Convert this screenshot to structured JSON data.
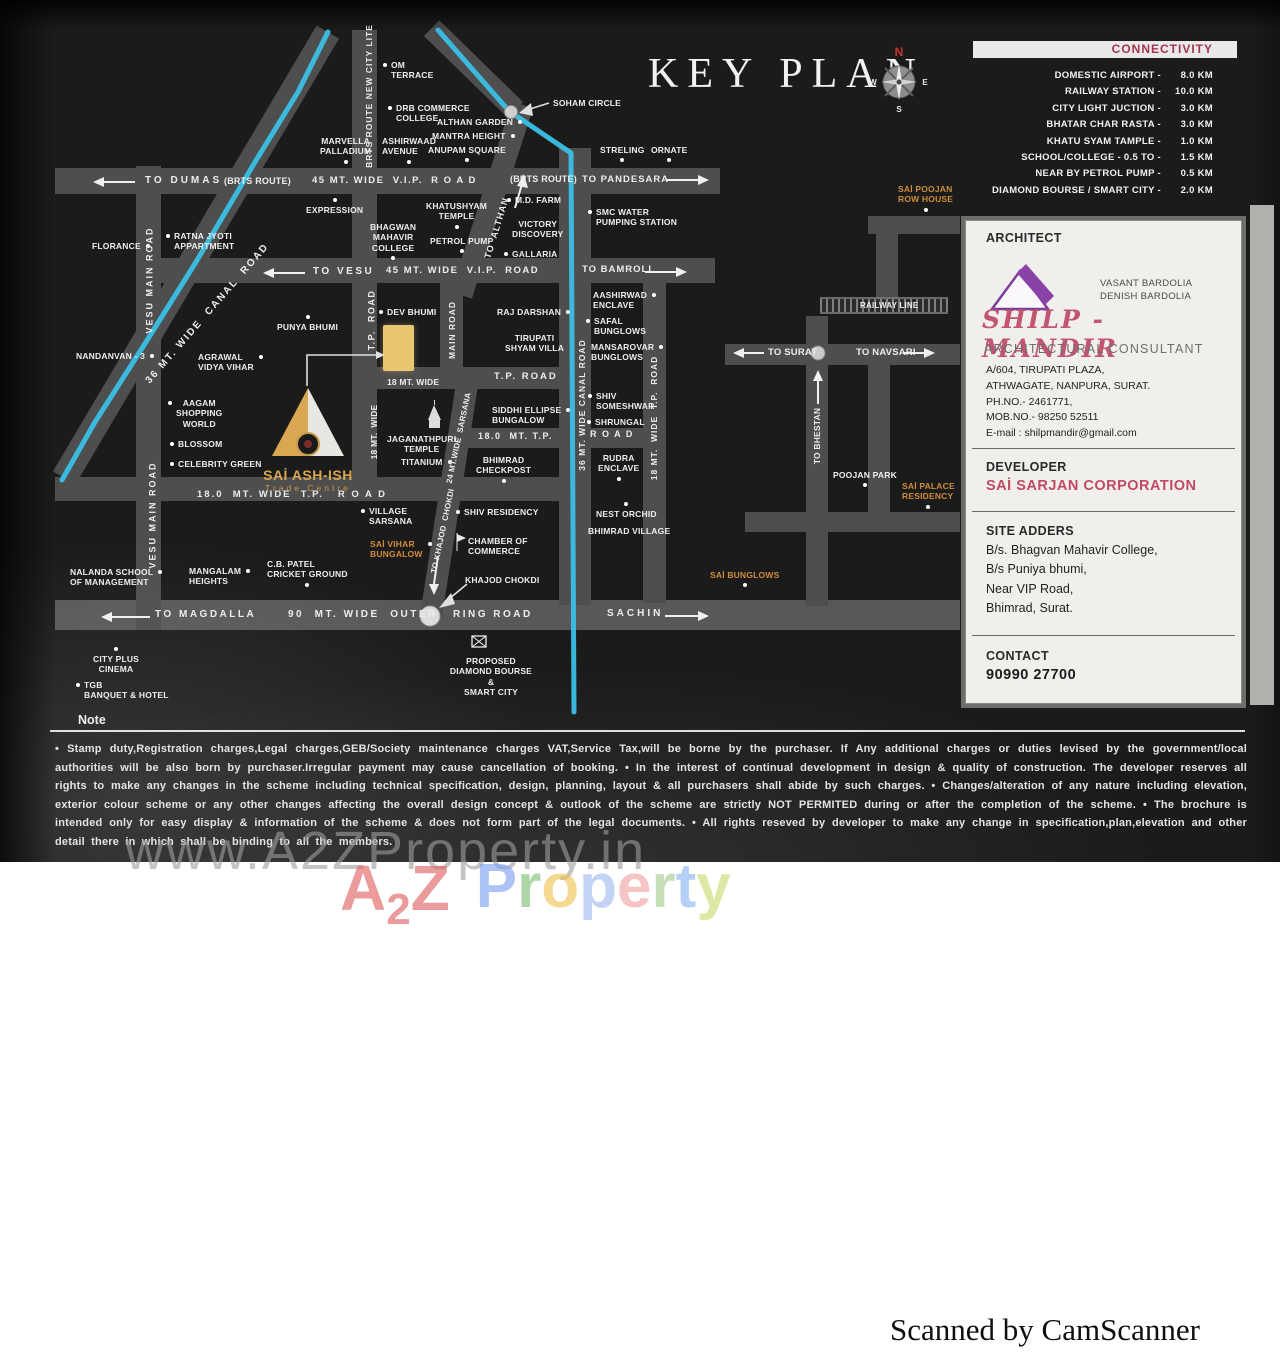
{
  "page": {
    "title": "KEY PLAN",
    "note_title": "Note",
    "note_text": "• Stamp duty,Registration charges,Legal charges,GEB/Society maintenance charges VAT,Service Tax,will be borne by the purchaser. If Any additional charges or duties levised by the government/local authorities will be also born by purchaser.Irregular payment may cause cancellation of booking. • In the interest of continual development in design & quality of construction. The developer reserves all rights to make any changes in the scheme including technical specification, design, planning, layout & all purchasers shall abide by such charges. • Changes/alteration of any nature including elevation, exterior colour scheme or any other changes affecting the overall design concept & outlook of the scheme are strictly NOT PERMITED during or after the completion of the scheme. • The brochure is intended only for easy display & information of the scheme & does not form part of the legal documents. • All rights reseved by developer to make any change in specification,plan,elevation and other detail there in which shall be binding to all the members.",
    "scanner_credit": "Scanned by CamScanner"
  },
  "compass": {
    "north": "N",
    "east": "E",
    "south": "S",
    "west": "W"
  },
  "connectivity": {
    "header": "CONNECTIVITY",
    "items": [
      {
        "label": "DOMESTIC AIRPORT -",
        "km": "8.0 KM"
      },
      {
        "label": "RAILWAY STATION  -",
        "km": "10.0 KM"
      },
      {
        "label": "CITY LIGHT JUCTION -",
        "km": "3.0 KM"
      },
      {
        "label": "BHATAR CHAR RASTA -",
        "km": "3.0 KM"
      },
      {
        "label": "KHATU SYAM TAMPLE -",
        "km": "1.0 KM"
      },
      {
        "label": "SCHOOL/COLLEGE - 0.5 TO -",
        "km": "1.5 KM"
      },
      {
        "label": "NEAR BY PETROL PUMP -",
        "km": "0.5 KM"
      },
      {
        "label": "DIAMOND BOURSE / SMART CITY -",
        "km": "2.0 KM"
      }
    ]
  },
  "info_card": {
    "architect": {
      "heading": "ARCHITECT",
      "names": [
        "VASANT BARDOLIA",
        "DENISH BARDOLIA"
      ],
      "brand": "SHILP - MANDIR",
      "subtitle": "ARCHITECTURAL CONSULTANT",
      "address_lines": [
        "A/604, TIRUPATI PLAZA,",
        "ATHWAGATE, NANPURA, SURAT.",
        "PH.NO.- 2461771,",
        "MOB.NO.- 98250 52511",
        "E-mail : shilpmandir@gmail.com"
      ]
    },
    "developer": {
      "heading": "DEVELOPER",
      "name": "SAİ SARJAN CORPORATION"
    },
    "site": {
      "heading": "SITE ADDERS",
      "lines": [
        "B/s. Bhagvan Mahavir College,",
        "B/s Puniya bhumi,",
        "Near VIP Road,",
        "Bhimrad, Surat."
      ]
    },
    "contact": {
      "heading": "CONTACT",
      "phone": "90990 27700"
    }
  },
  "map": {
    "site_logo": {
      "name": "SAİ ASH-ISH",
      "tagline": "Trade Centre"
    },
    "accent_colors": {
      "orange_label": "#cf8c3a",
      "canal": "#3ac0e6",
      "gold_plot": "#e9c771"
    },
    "labels": [
      {
        "t": "OM\nTERRACE",
        "x": 391,
        "y": 60,
        "d": "l"
      },
      {
        "t": "DRB COMMERCE\nCOLLEGE",
        "x": 396,
        "y": 103,
        "d": "l"
      },
      {
        "t": "ALTHAN GARDEN",
        "x": 437,
        "y": 117,
        "d": "r"
      },
      {
        "t": "MANTRA HEIGHT",
        "x": 432,
        "y": 131,
        "d": "r"
      },
      {
        "t": "ANUPAM SQUARE",
        "x": 428,
        "y": 145,
        "d": "b"
      },
      {
        "t": "ASHIRWAAD\nAVENUE",
        "x": 382,
        "y": 136,
        "d": "b"
      },
      {
        "t": "MARVELLA\nPALLADIUM",
        "x": 320,
        "y": 136,
        "a": 1,
        "d": "b"
      },
      {
        "t": "SOHAM CIRCLE",
        "x": 553,
        "y": 98
      },
      {
        "t": "STRELING",
        "x": 600,
        "y": 145,
        "d": "b"
      },
      {
        "t": "ORNATE",
        "x": 651,
        "y": 145,
        "d": "b"
      },
      {
        "t": "EXPRESSION",
        "x": 306,
        "y": 205,
        "d": "t"
      },
      {
        "t": "KHATUSHYAM\nTEMPLE",
        "x": 426,
        "y": 201,
        "a": 1,
        "d": "b"
      },
      {
        "t": "M.D. FARM",
        "x": 515,
        "y": 195,
        "d": "l"
      },
      {
        "t": "SMC WATER\nPUMPING STATION",
        "x": 596,
        "y": 207,
        "d": "l"
      },
      {
        "t": "VICTORY\nDISCOVERY",
        "x": 512,
        "y": 219,
        "a": 1
      },
      {
        "t": "BHAGWAN\nMAHAVIR\nCOLLEGE",
        "x": 370,
        "y": 222,
        "a": 1,
        "d": "b"
      },
      {
        "t": "PETROL PUMP",
        "x": 430,
        "y": 236,
        "d": "b"
      },
      {
        "t": "GALLARIA",
        "x": 512,
        "y": 249,
        "d": "l"
      },
      {
        "t": "FLORANCE",
        "x": 92,
        "y": 241,
        "d": "r"
      },
      {
        "t": "RATNA JYOTI\nAPPARTMENT",
        "x": 174,
        "y": 231,
        "d": "l"
      },
      {
        "t": "NANDANVAN - 3",
        "x": 76,
        "y": 351,
        "d": "r"
      },
      {
        "t": "AGRAWAL\nVIDYA VIHAR",
        "x": 198,
        "y": 352,
        "d": "r"
      },
      {
        "t": "PUNYA BHUMI",
        "x": 277,
        "y": 322,
        "d": "t"
      },
      {
        "t": "DEV BHUMI",
        "x": 387,
        "y": 307,
        "d": "l"
      },
      {
        "t": "RAJ DARSHAN",
        "x": 497,
        "y": 307,
        "d": "r"
      },
      {
        "t": "TIRUPATI\nSHYAM VILLA",
        "x": 505,
        "y": 333,
        "a": 1
      },
      {
        "t": "AASHIRWAD\nENCLAVE",
        "x": 593,
        "y": 290,
        "d": "r"
      },
      {
        "t": "SAFAL\nBUNGLOWS",
        "x": 594,
        "y": 316,
        "d": "l"
      },
      {
        "t": "MANSAROVAR\nBUNGLOWS",
        "x": 591,
        "y": 342,
        "d": "r"
      },
      {
        "t": "SHIV\nSOMESHWAR",
        "x": 596,
        "y": 391,
        "d": "l"
      },
      {
        "t": "SHRUNGAL",
        "x": 595,
        "y": 417,
        "d": "l"
      },
      {
        "t": "RUDRA\nENCLAVE",
        "x": 598,
        "y": 453,
        "a": 1,
        "d": "b"
      },
      {
        "t": "NEST ORCHID",
        "x": 596,
        "y": 509,
        "d": "t"
      },
      {
        "t": "BHIMRAD VILLAGE",
        "x": 588,
        "y": 526
      },
      {
        "t": "AAGAM\nSHOPPING\nWORLD",
        "x": 176,
        "y": 398,
        "a": 1,
        "d": "l"
      },
      {
        "t": "BLOSSOM",
        "x": 178,
        "y": 439,
        "d": "l"
      },
      {
        "t": "CELEBRITY GREEN",
        "x": 178,
        "y": 459,
        "d": "l"
      },
      {
        "t": "JAGANATHPURI\nTEMPLE",
        "x": 387,
        "y": 434,
        "a": 1
      },
      {
        "t": "TITANIUM",
        "x": 401,
        "y": 457,
        "d": "r"
      },
      {
        "t": "SIDDHI ELLIPSE\nBUNGALOW",
        "x": 492,
        "y": 405,
        "d": "r"
      },
      {
        "t": "BHIMRAD\nCHECKPOST",
        "x": 476,
        "y": 455,
        "a": 1,
        "d": "b"
      },
      {
        "t": "VILLAGE\nSARSANA",
        "x": 369,
        "y": 506,
        "d": "l"
      },
      {
        "t": "SAİ VIHAR\nBUNGALOW",
        "x": 370,
        "y": 539,
        "c": "o",
        "d": "r"
      },
      {
        "t": "SHIV RESIDENCY",
        "x": 464,
        "y": 507,
        "d": "l"
      },
      {
        "t": "CHAMBER OF\nCOMMERCE",
        "x": 468,
        "y": 536
      },
      {
        "t": "KHAJOD CHOKDI",
        "x": 465,
        "y": 575
      },
      {
        "t": "C.B. PATEL\nCRICKET GROUND",
        "x": 267,
        "y": 559,
        "d": "b"
      },
      {
        "t": "MANGALAM\nHEIGHTS",
        "x": 189,
        "y": 566,
        "d": "r"
      },
      {
        "t": "NALANDA SCHOOL\nOF MANAGEMENT",
        "x": 70,
        "y": 567,
        "d": "r"
      },
      {
        "t": "CITY PLUS\nCINEMA",
        "x": 93,
        "y": 654,
        "a": 1,
        "d": "t"
      },
      {
        "t": "TGB\nBANQUET & HOTEL",
        "x": 84,
        "y": 680,
        "d": "l"
      },
      {
        "t": "SAİ BUNGLOWS",
        "x": 710,
        "y": 570,
        "c": "o",
        "d": "b"
      },
      {
        "t": "POOJAN PARK",
        "x": 833,
        "y": 470,
        "d": "b"
      },
      {
        "t": "SAİ PALACE\nRESIDENCY",
        "x": 902,
        "y": 481,
        "c": "o",
        "d": "b"
      },
      {
        "t": "SAİ POOJAN\nROW HOUSE",
        "x": 898,
        "y": 184,
        "c": "o",
        "d": "b"
      },
      {
        "t": "PROPOSED\nDIAMOND BOURSE\n&\nSMART CITY",
        "x": 443,
        "y": 656,
        "a": 1,
        "w": 96
      },
      {
        "t": "RAILWAY LINE",
        "x": 860,
        "y": 301,
        "s": 8
      },
      {
        "t": "TO DUMAS",
        "x": 145,
        "y": 175,
        "s": 10,
        "ls": 3
      },
      {
        "t": "(BRTS ROUTE)",
        "x": 224,
        "y": 176,
        "s": 9
      },
      {
        "t": "45 MT. WIDE  V.I.P.  R O A D",
        "x": 312,
        "y": 175,
        "s": 9.5,
        "ls": 1.5
      },
      {
        "t": "(BRTS ROUTE)",
        "x": 510,
        "y": 174,
        "s": 9
      },
      {
        "t": "TO PANDESARA",
        "x": 582,
        "y": 174,
        "s": 9.5,
        "ls": 1
      },
      {
        "t": "TO VESU",
        "x": 313,
        "y": 266,
        "s": 10,
        "ls": 2.5
      },
      {
        "t": "45 MT. WIDE  V.I.P.  ROAD",
        "x": 386,
        "y": 265,
        "s": 9.5,
        "ls": 1.5
      },
      {
        "t": "TO BAMROLI",
        "x": 582,
        "y": 264,
        "s": 9.5,
        "ls": 1
      },
      {
        "t": "T.P. ROAD",
        "x": 494,
        "y": 371,
        "s": 9.5,
        "ls": 2
      },
      {
        "t": "18 MT. WIDE",
        "x": 387,
        "y": 377,
        "s": 8.5
      },
      {
        "t": "18.0  MT. T.P.",
        "x": 478,
        "y": 431,
        "s": 9,
        "ls": 1.5
      },
      {
        "t": "R O A D",
        "x": 590,
        "y": 429,
        "s": 9,
        "ls": 1.5
      },
      {
        "t": "18.0  MT. WIDE  T.P.   R O A D",
        "x": 197,
        "y": 489,
        "s": 9.5,
        "ls": 2
      },
      {
        "t": "TO MAGDALLA",
        "x": 155,
        "y": 609,
        "s": 10,
        "ls": 2.5
      },
      {
        "t": "90  MT. WIDE  OUTER",
        "x": 288,
        "y": 609,
        "s": 10,
        "ls": 2.5
      },
      {
        "t": "RING ROAD",
        "x": 453,
        "y": 609,
        "s": 10,
        "ls": 2.5
      },
      {
        "t": "SACHIN",
        "x": 607,
        "y": 608,
        "s": 10,
        "ls": 3
      },
      {
        "t": "TO SURAT",
        "x": 768,
        "y": 347,
        "s": 9.5
      },
      {
        "t": "TO NAVSARI",
        "x": 856,
        "y": 347,
        "s": 9.5
      },
      {
        "t": "VESU MAIN ROAD",
        "x": 150,
        "y": 280,
        "r": -90,
        "s": 9,
        "ls": 2
      },
      {
        "t": "VESU MAIN ROAD",
        "x": 153,
        "y": 515,
        "r": -90,
        "s": 9,
        "ls": 2
      },
      {
        "t": "BRTS ROUTE NEW CITY LITE",
        "x": 369,
        "y": 96,
        "r": -90,
        "s": 8.5,
        "ls": 1
      },
      {
        "t": "T.P.  ROAD",
        "x": 372,
        "y": 320,
        "r": -90,
        "s": 9,
        "ls": 1.5
      },
      {
        "t": "MAIN ROAD",
        "x": 452,
        "y": 330,
        "r": -90,
        "s": 8.5,
        "ls": 1
      },
      {
        "t": "18 MT.  WIDE",
        "x": 374,
        "y": 432,
        "r": -90,
        "s": 8.5
      },
      {
        "t": "36 MT. WIDE CANAL ROAD",
        "x": 582,
        "y": 405,
        "r": -90,
        "s": 8.5,
        "ls": 1
      },
      {
        "t": "18 MT.  WIDE  T.P.  ROAD",
        "x": 654,
        "y": 418,
        "r": -90,
        "s": 8.5,
        "ls": 1
      },
      {
        "t": "TO BHESTAN",
        "x": 817,
        "y": 436,
        "r": -90,
        "s": 8.5
      },
      {
        "t": "TO  ALTHAN",
        "x": 497,
        "y": 228,
        "r": -73,
        "s": 9,
        "ls": 1
      },
      {
        "t": "36 MT. WIDE  CANAL  ROAD",
        "x": 208,
        "y": 314,
        "r": -49,
        "s": 10,
        "ls": 2
      },
      {
        "t": "24 MT.WIDE  SARSANA",
        "x": 459,
        "y": 438,
        "r": -78,
        "s": 8
      },
      {
        "t": "TO KHAJOD  CHOKDI",
        "x": 443,
        "y": 531,
        "r": -78,
        "s": 8
      }
    ]
  },
  "watermark": {
    "url_text": "www.A2ZProperty.in",
    "a2z_letters": [
      {
        "ch": "A",
        "color": "#e05f5f",
        "size": 64
      },
      {
        "ch": "2",
        "color": "#e05f5f",
        "size": 44,
        "dy": 14
      },
      {
        "ch": "Z",
        "color": "#e05f5f",
        "size": 64
      }
    ],
    "property_letters": [
      {
        "ch": "P",
        "color": "#7e9ff0",
        "size": 62
      },
      {
        "ch": "r",
        "color": "#7cbf72",
        "size": 62
      },
      {
        "ch": "o",
        "color": "#f0c24e",
        "size": 62
      },
      {
        "ch": "p",
        "color": "#9db9f2",
        "size": 62
      },
      {
        "ch": "e",
        "color": "#f0a3a3",
        "size": 62
      },
      {
        "ch": "r",
        "color": "#a3cc8e",
        "size": 62
      },
      {
        "ch": "t",
        "color": "#88b2f2",
        "size": 62
      },
      {
        "ch": "y",
        "color": "#ccd96e",
        "size": 62
      }
    ]
  }
}
